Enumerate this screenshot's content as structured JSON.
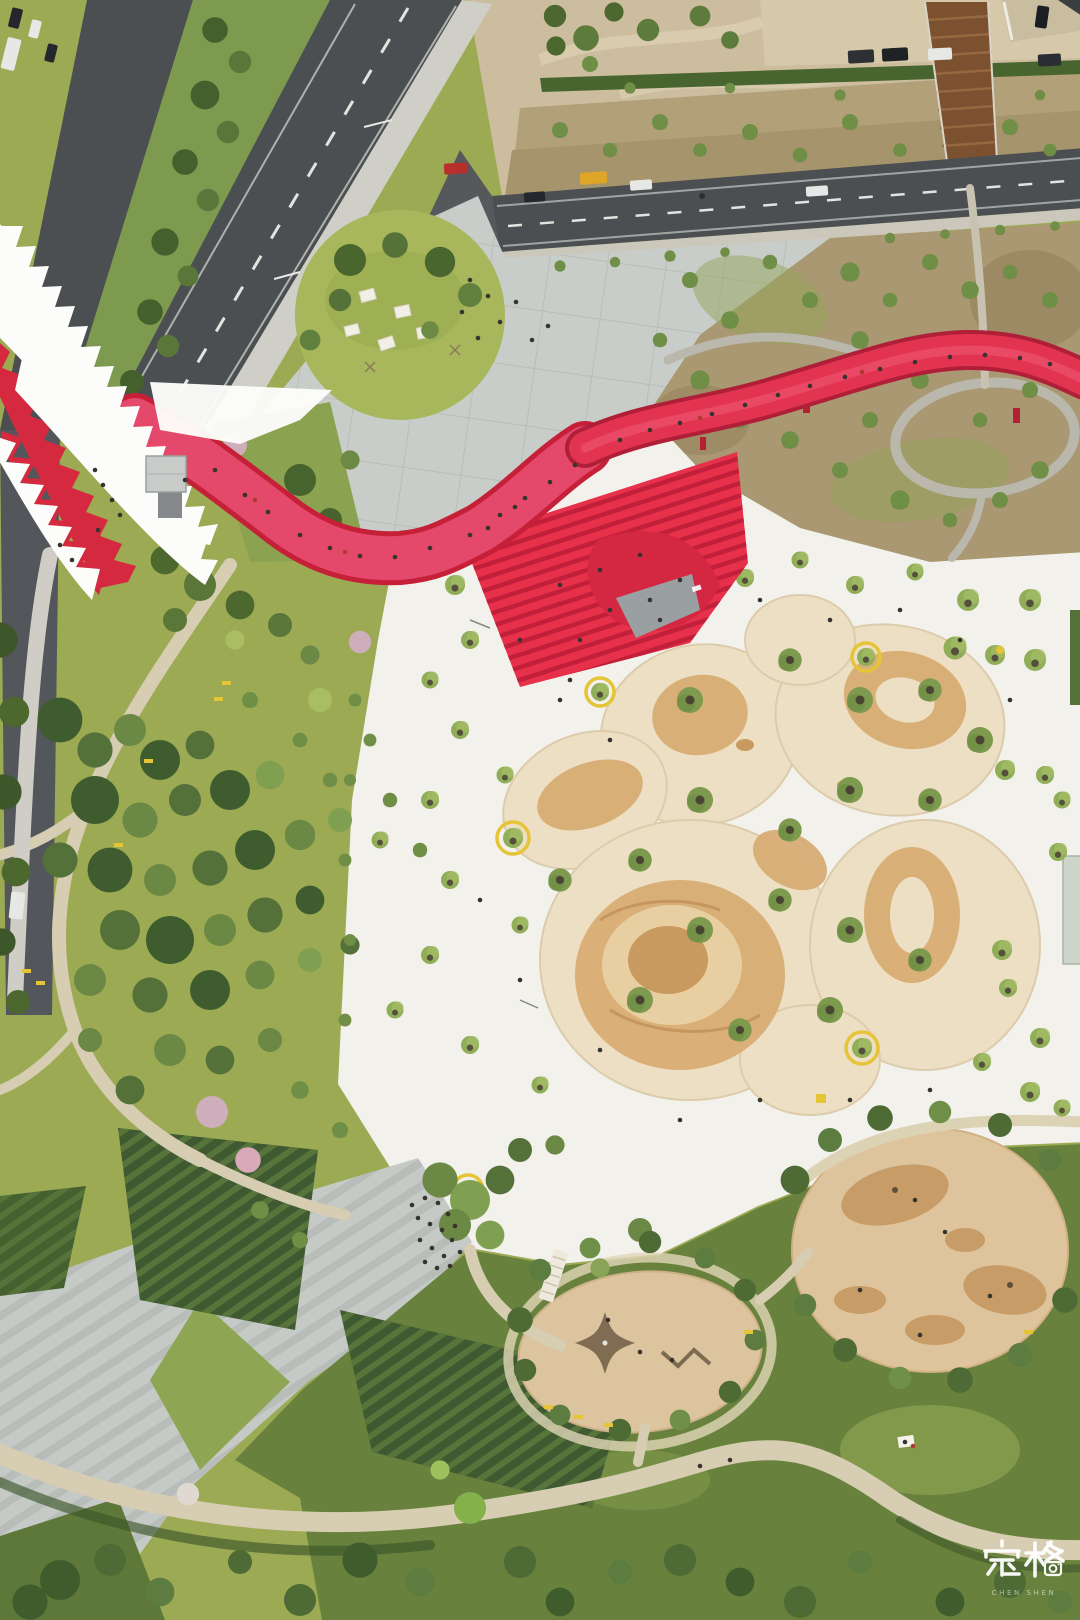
{
  "scene": {
    "type": "aerial-photograph",
    "view": "top-down drone view",
    "subject": "Urban park with red serpentine elevated walkway, red stepped amphitheater pavilion, white plaza with organic sand play mounds, circular lawn, playgrounds, meadows and city roads",
    "time": "daytime"
  },
  "watermark": {
    "text": "定格",
    "subtext": "CHEN SHEN",
    "color": "#ffffff",
    "icon": "camera-icon"
  },
  "palette": {
    "grass": "#9caa54",
    "grassBand": "#68823d",
    "road": "#4b4f52",
    "roadLine": "#e3e4df",
    "sidewalk": "#cfcfc7",
    "median": "#7e9a4f",
    "dirt": "#cbbd9e",
    "slope": "#b2a078",
    "hedge": "#49652f",
    "meadow": "#a99871",
    "plazaGray": "#c9cdc9",
    "plazaGrid": "#b6bab6",
    "lawn": "#a8b75c",
    "plazaWhite": "#f2f1ec",
    "canopy": "#fcfcfa",
    "canopyRed": "#d5293f",
    "ribbon": "#e4486b",
    "ribbonEdge": "#c52038",
    "bridge": "#e23350",
    "bridgeEdge": "#b01f38",
    "stairBase": "#e73049",
    "stairLine": "#c21f3a",
    "roof": "#9aa0a2",
    "sand": "#ecdfc3",
    "sandPool": "#d9ad74",
    "sandPoolDeep": "#c89a60",
    "playSand": "#dcc49e",
    "playSandDark": "#c79c66",
    "pathTan": "#d6cdb2",
    "pavement": "#c6cac6",
    "pavementLine": "#afb3af",
    "bed": "#3f5a30",
    "bedRow": "#5d7a3e",
    "treeDark": "#4c682f",
    "treeMid": "#6f8f46",
    "treeLight": "#90ad57",
    "blossom": "#cfaebc",
    "loop": "#bab7ac",
    "wood": "#7c5130",
    "kiosk": "#c8cbc8",
    "yellow": "#e6c437",
    "people": "#35342f",
    "white": "#ffffff",
    "carDark": "#24272b",
    "carWhite": "#e6e8e6",
    "carRed": "#b8302c",
    "truckYellow": "#dfa527"
  },
  "features": [
    {
      "name": "city-road",
      "label": "Multi-lane city roads with traffic"
    },
    {
      "name": "white-canopy",
      "label": "White sawtooth fan canopy with red edges"
    },
    {
      "name": "red-walkway",
      "label": "Red elevated serpentine walkway with pedestrians"
    },
    {
      "name": "red-grandstand",
      "label": "Red stepped amphitheater roof"
    },
    {
      "name": "gray-plaza",
      "label": "Gray tiled plaza with circular lawn"
    },
    {
      "name": "white-plaza",
      "label": "White plaza with young trees"
    },
    {
      "name": "sand-mounds",
      "label": "Organic-shaped sand play mounds"
    },
    {
      "name": "playgrounds",
      "label": "Circular sand playgrounds with climbing nets"
    },
    {
      "name": "park-green",
      "label": "Park lawns, tree clusters and winding paths"
    }
  ]
}
